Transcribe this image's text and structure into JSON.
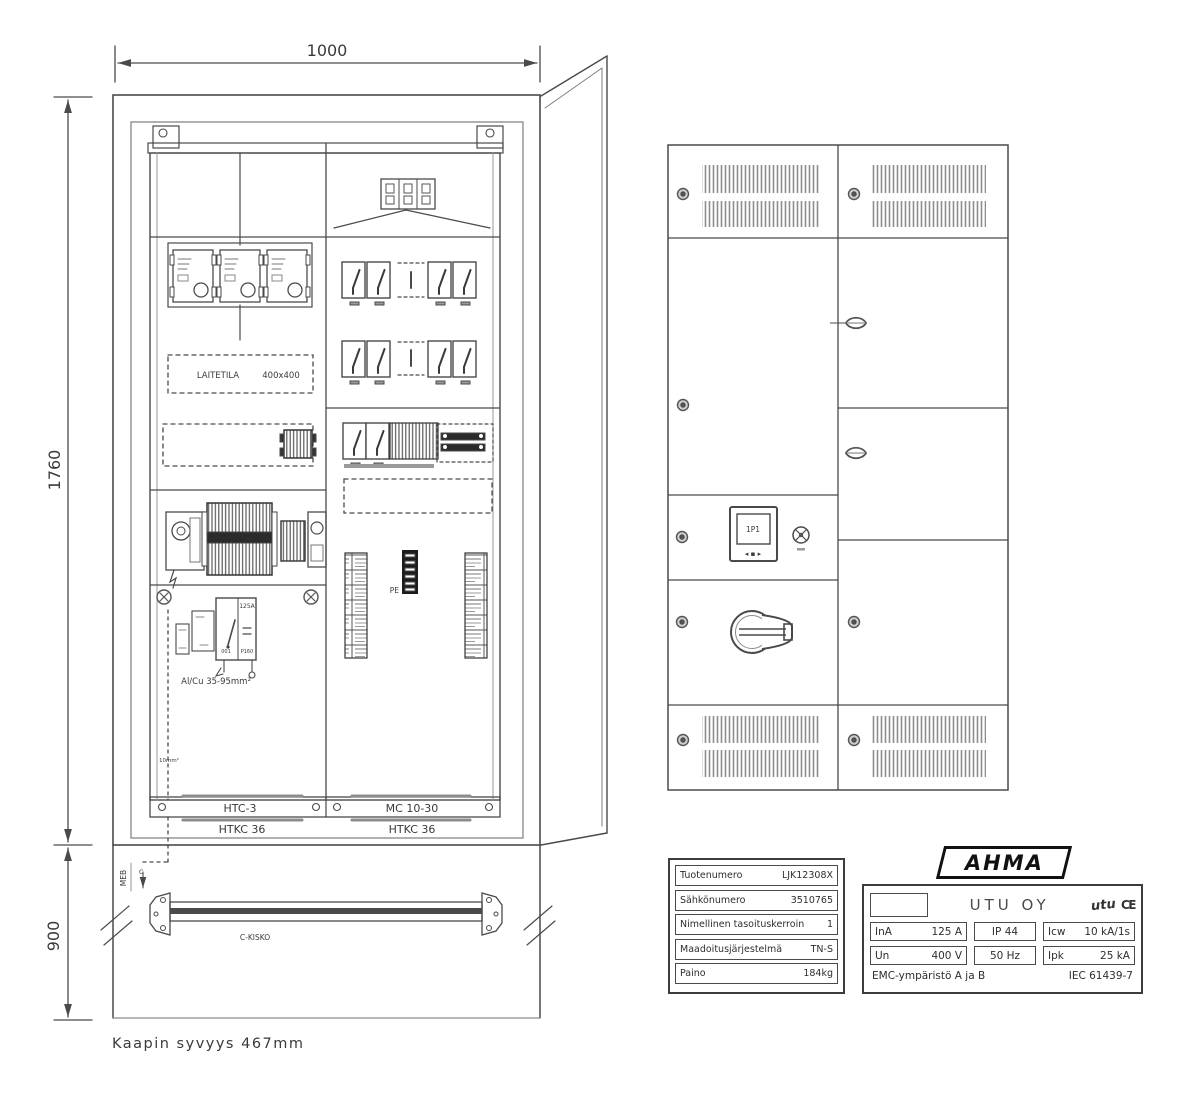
{
  "front_view": {
    "dim_width": "1000",
    "dim_height": "1760",
    "dim_plinth": "900",
    "depth_note": "Kaapin syvyys 467mm",
    "laitetila_label": "LAITETILA",
    "laitetila_size": "400x400",
    "switch_rating": "125A",
    "switch_ref1": "001",
    "switch_ref2": "P160",
    "cable_note": "Al/Cu 35-95mm²",
    "earth_note": "10mm²",
    "pe_label": "PE",
    "meb_label": "MEB",
    "meb_sub": "C",
    "rail_label": "C-KISKO",
    "frame_left_label": "HTC-3",
    "frame_right_label": "MC 10-30",
    "cover_left_label": "HTKC 36",
    "cover_right_label": "HTKC 36"
  },
  "door_view": {
    "display_label": "1P1",
    "display_buttons": "◂ ▪ ▸"
  },
  "product_table": {
    "rows": [
      {
        "label": "Tuotenumero",
        "value": "LJK12308X"
      },
      {
        "label": "Sähkönumero",
        "value": "3510765"
      },
      {
        "label": "Nimellinen tasoituskerroin",
        "value": "1"
      },
      {
        "label": "Maadoitusjärjestelmä",
        "value": "TN-S"
      },
      {
        "label": "Paino",
        "value": "184kg"
      }
    ]
  },
  "nameplate": {
    "brand": "AHMA",
    "company": "UTU OY",
    "logo": "utu",
    "ce": "CE",
    "cells": [
      {
        "label": "InA",
        "value": "125 A"
      },
      {
        "label": "",
        "value": "IP 44"
      },
      {
        "label": "Icw",
        "value": "10 kA/1s"
      },
      {
        "label": "Un",
        "value": "400 V"
      },
      {
        "label": "",
        "value": "50 Hz"
      },
      {
        "label": "Ipk",
        "value": "25 kA"
      }
    ],
    "footer_left": "EMC-ympäristö A ja B",
    "footer_right": "IEC 61439-7"
  }
}
